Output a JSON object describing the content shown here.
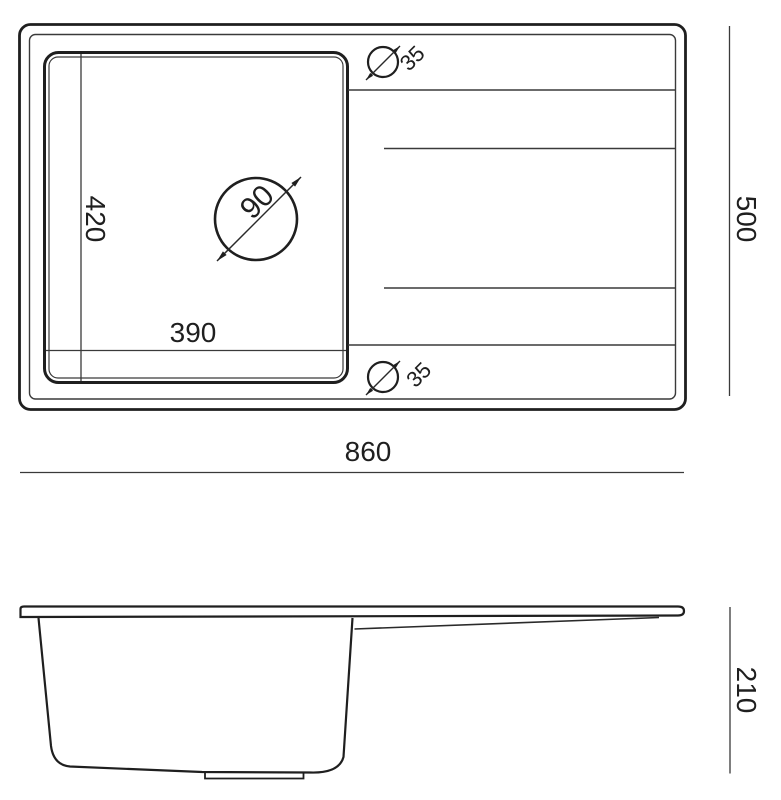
{
  "drawing_title": "sink-dimension-drawing",
  "colors": {
    "background": "#ffffff",
    "line": "#1f1f1f",
    "thin_line": "#3a3a3a",
    "text": "#1f1f1f"
  },
  "top_view": {
    "overall_width": "860",
    "overall_depth": "500",
    "bowl_width": "390",
    "bowl_depth": "420",
    "drain_diameter": "90",
    "tap_hole_top_diameter": "35",
    "tap_hole_bottom_diameter": "35"
  },
  "side_view": {
    "overall_height": "210"
  }
}
